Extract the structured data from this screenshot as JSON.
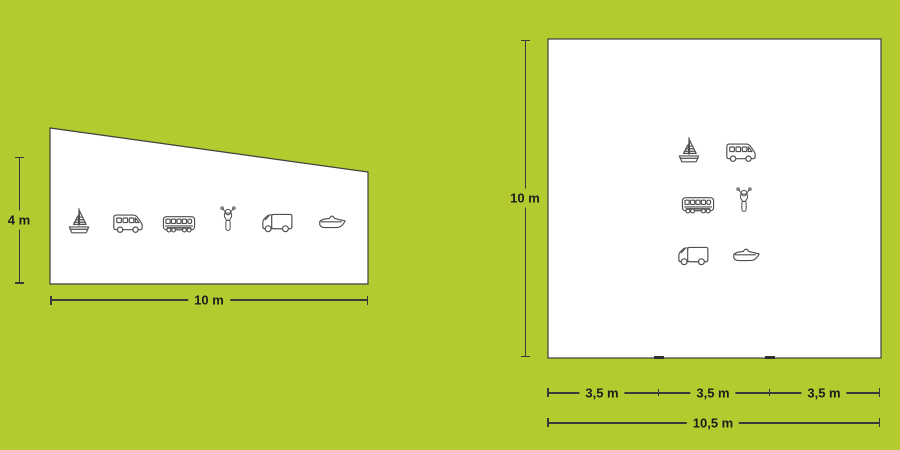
{
  "diagram": {
    "description": "Two white parking-lot shapes with vehicle icons on a green background",
    "colors": {
      "background": "#b4cb2f",
      "shape_fill": "#ffffff",
      "shape_stroke": "#3f3f3f",
      "icon_stroke": "#4f4f4f",
      "dimension_line": "#3a3a3a",
      "label_text": "#1d1d1d"
    },
    "left_figure": {
      "shape": "trapezoid",
      "height_label": "4 m",
      "base_label": "10 m",
      "icons": [
        "sailboat",
        "minibus",
        "bus",
        "scooter",
        "truck",
        "speedboat"
      ]
    },
    "right_figure": {
      "shape": "square",
      "height_label": "10 m",
      "segment_labels": [
        "3,5 m",
        "3,5 m",
        "3,5 m"
      ],
      "total_label": "10,5 m",
      "icons": [
        "sailboat",
        "minibus",
        "bus",
        "scooter",
        "truck",
        "speedboat"
      ]
    }
  }
}
